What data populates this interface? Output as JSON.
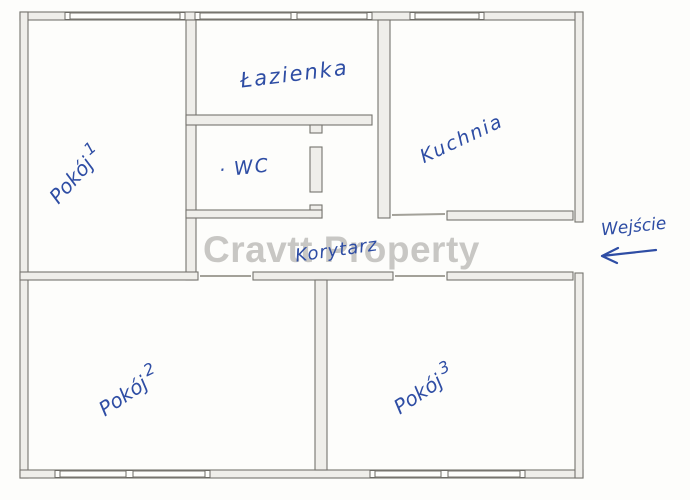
{
  "watermark": {
    "text": "Cravtt Property",
    "color": "#c8c7c4"
  },
  "plan": {
    "ink_color": "#2e4da4",
    "wall_stroke": "#76746e",
    "wall_fill": "#efeeea",
    "background": "#fdfdfb",
    "rooms": {
      "pokoj1": {
        "label": "Pokój",
        "number": "1"
      },
      "lazienka": {
        "label": "Łazienka"
      },
      "wc": {
        "bullet": "·",
        "label": "WC"
      },
      "kuchnia": {
        "label": "Kuchnia"
      },
      "korytarz": {
        "label": "Korytarz"
      },
      "pokoj2": {
        "label": "Pokój",
        "number": "2"
      },
      "pokoj3": {
        "label": "Pokój",
        "number": "3"
      }
    },
    "entrance": {
      "label": "Wejście",
      "arrow_direction": "left"
    }
  }
}
